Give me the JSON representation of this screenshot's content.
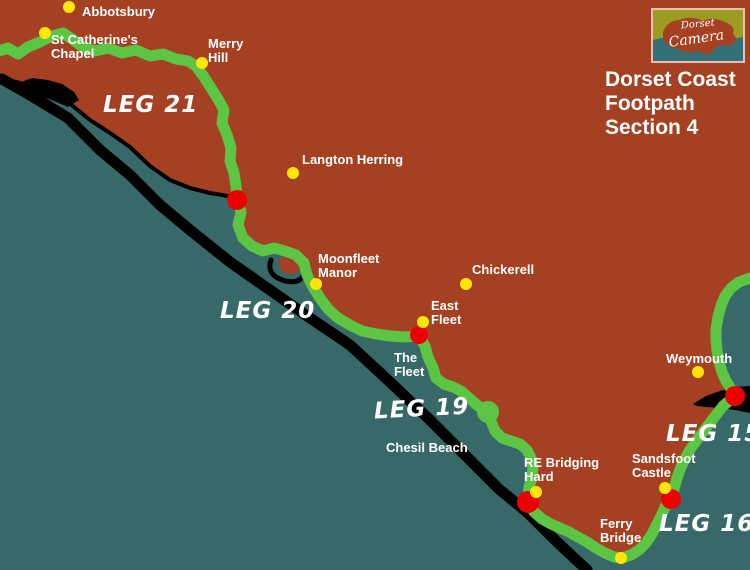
{
  "title": {
    "line1": "Dorset Coast",
    "line2": "Footpath",
    "line3": "Section 4"
  },
  "logo": {
    "top": "Dorset",
    "bottom": "Camera"
  },
  "legs": [
    {
      "id": "leg-21",
      "label": "LEG 21"
    },
    {
      "id": "leg-20",
      "label": "LEG 20"
    },
    {
      "id": "leg-19",
      "label": "LEG 19"
    },
    {
      "id": "leg-15",
      "label": "LEG 15"
    },
    {
      "id": "leg-16",
      "label": "LEG 16"
    }
  ],
  "places": [
    {
      "id": "abbotsbury",
      "line1": "Abbotsbury"
    },
    {
      "id": "st-catherines-chapel",
      "line1": "St Catherine's",
      "line2": "Chapel"
    },
    {
      "id": "merry-hill",
      "line1": "Merry",
      "line2": "Hill"
    },
    {
      "id": "langton-herring",
      "line1": "Langton Herring"
    },
    {
      "id": "moonfleet-manor",
      "line1": "Moonfleet",
      "line2": "Manor"
    },
    {
      "id": "chickerell",
      "line1": "Chickerell"
    },
    {
      "id": "east-fleet",
      "line1": "East",
      "line2": "Fleet"
    },
    {
      "id": "re-bridging-hard",
      "line1": "RE Bridging",
      "line2": "Hard"
    },
    {
      "id": "sandsfoot-castle",
      "line1": "Sandsfoot",
      "line2": "Castle"
    },
    {
      "id": "ferry-bridge",
      "line1": "Ferry",
      "line2": "Bridge"
    },
    {
      "id": "weymouth",
      "line1": "Weymouth"
    }
  ],
  "water": [
    {
      "id": "the-fleet",
      "line1": "The",
      "line2": "Fleet"
    },
    {
      "id": "chesil-beach",
      "line1": "Chesil Beach"
    }
  ],
  "colors": {
    "sea": "#386969",
    "land": "#A54122",
    "route": "#5CC544",
    "beach": "#000000",
    "dot_yellow": "#FFE606",
    "dot_red": "#EE0000",
    "logo_olive": "#9C9C20",
    "logo_teal": "#337078",
    "text": "#FFFFFF"
  }
}
